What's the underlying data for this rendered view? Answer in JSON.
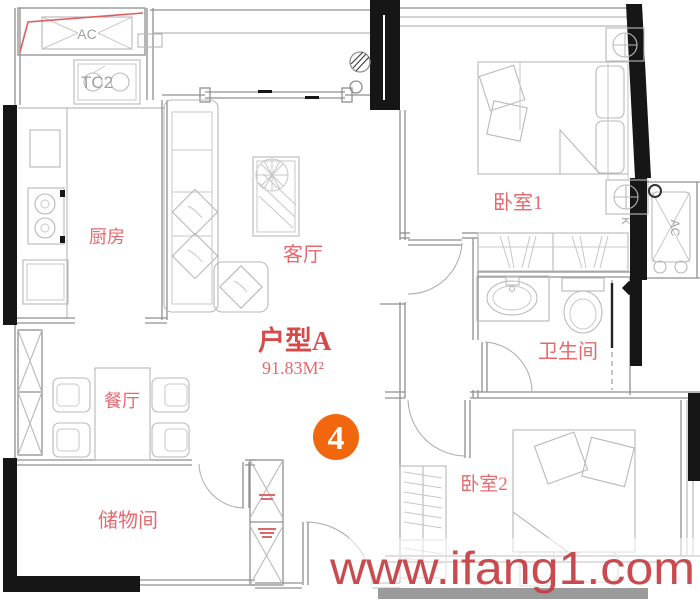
{
  "plan": {
    "unit_label": "户型A",
    "area_label": "91.83M²",
    "unit_number": "4",
    "rooms": {
      "kitchen": "厨房",
      "living": "客厅",
      "dining": "餐厅",
      "storage": "储物间",
      "bedroom1": "卧室1",
      "bathroom": "卫生间",
      "bedroom2": "卧室2"
    },
    "annotations": {
      "ac_top": "AC",
      "ac_right": "AC",
      "sink_label": "TC2",
      "k_label": "K"
    },
    "colors": {
      "label_red": "#e4696f",
      "accent_red": "#d64a4a",
      "badge_orange": "#f2660d",
      "wall_black": "#161616",
      "line_gray": "#8f8f8f",
      "furniture_gray": "#b9b9b9",
      "watermark_red": "#c63c41"
    }
  },
  "watermark": {
    "text": "www.ifang1.com"
  }
}
